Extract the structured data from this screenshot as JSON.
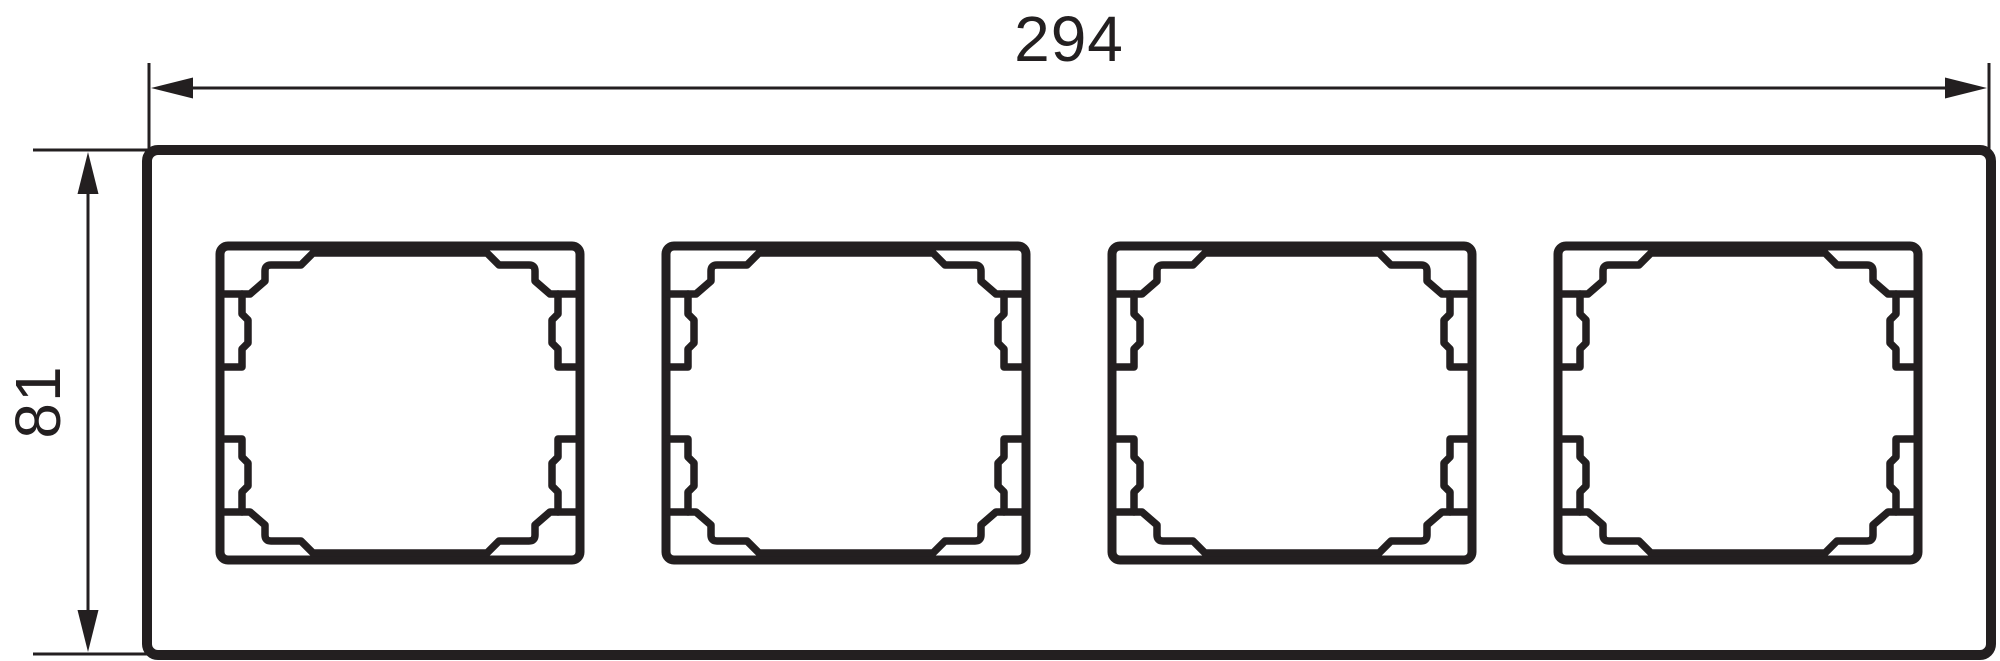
{
  "drawing": {
    "type": "technical-dimension-drawing",
    "subject": "four-gang-switch-frame-front-view",
    "horizontal_dimension": "294",
    "vertical_dimension": "81",
    "opening_count": 4,
    "ink_color": "#231f20",
    "background_color": "#ffffff"
  }
}
